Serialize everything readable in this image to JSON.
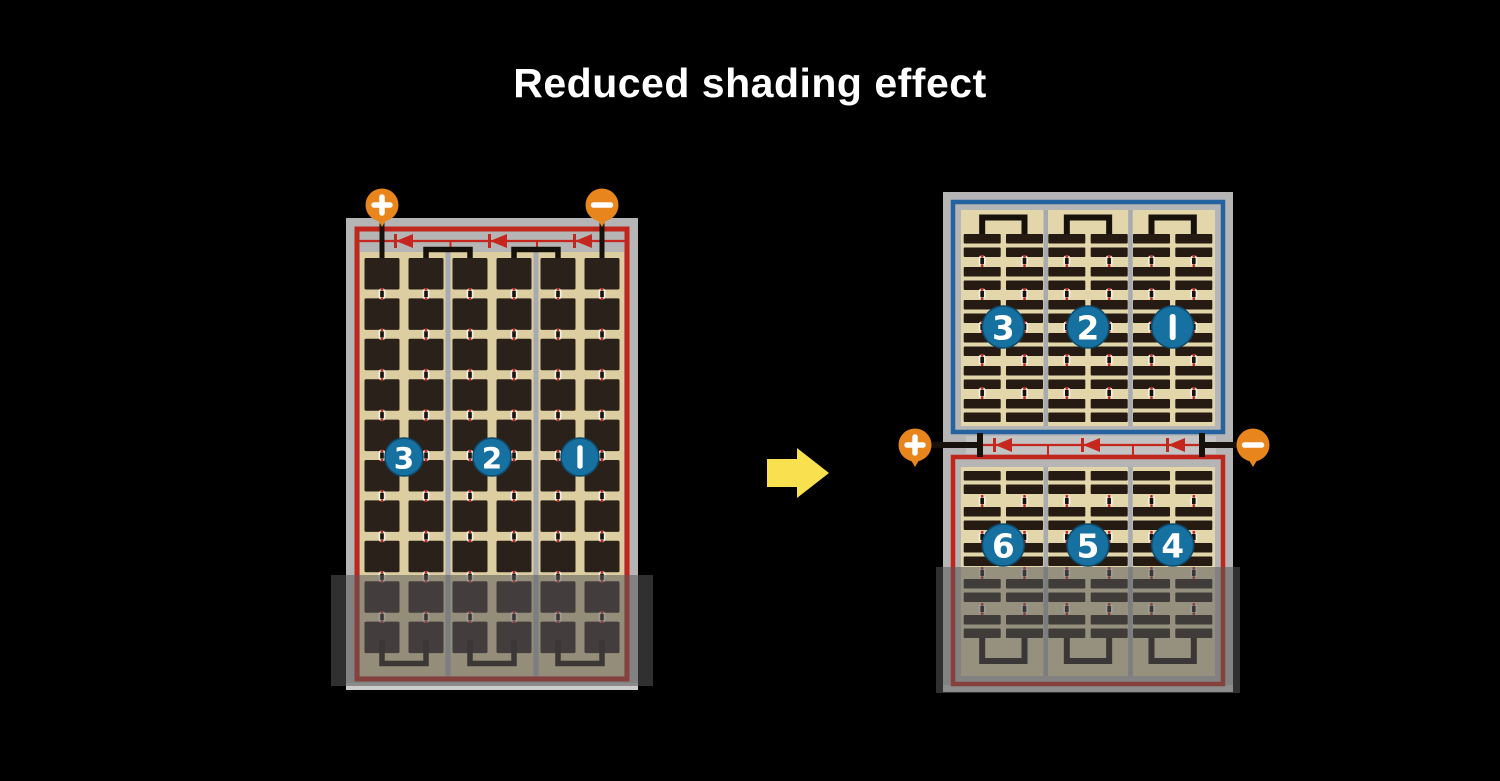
{
  "title": "Reduced shading effect",
  "colors": {
    "background": "#000000",
    "title_text": "#ffffff",
    "panel_frame_gray": "#b5b5b6",
    "panel_frame_edge": "#cdcdcd",
    "cell_area_tan_left": "#dccea0",
    "cell_area_tan_right": "#e3d6aa",
    "cell_dark_left": "#2b211b",
    "cell_dark_right": "#251b13",
    "group_divider_gray": "#a8aab1",
    "left_circuit_red": "#c0261c",
    "right_top_circuit_blue": "#2563a0",
    "right_bottom_circuit_red": "#c0261c",
    "diode_red": "#c5271f",
    "terminal_orange": "#e8851c",
    "terminal_symbol_white": "#ffffff",
    "string_circle_blue": "#1670a0",
    "string_circle_border": "#0d4a6b",
    "string_number_white": "#ffffff",
    "wire_black": "#17110c",
    "connector_dot_white": "#f4efe2",
    "arrow_yellow": "#f8e04e",
    "shade_overlay": "rgba(88,88,90,0.55)"
  },
  "left_panel": {
    "positive_terminal_label": "+",
    "negative_terminal_label": "−",
    "string_labels": [
      "3",
      "2",
      "1"
    ]
  },
  "right_panel": {
    "positive_terminal_label": "+",
    "negative_terminal_label": "−",
    "top_string_labels": [
      "3",
      "2",
      "1"
    ],
    "bottom_string_labels": [
      "6",
      "5",
      "4"
    ]
  }
}
